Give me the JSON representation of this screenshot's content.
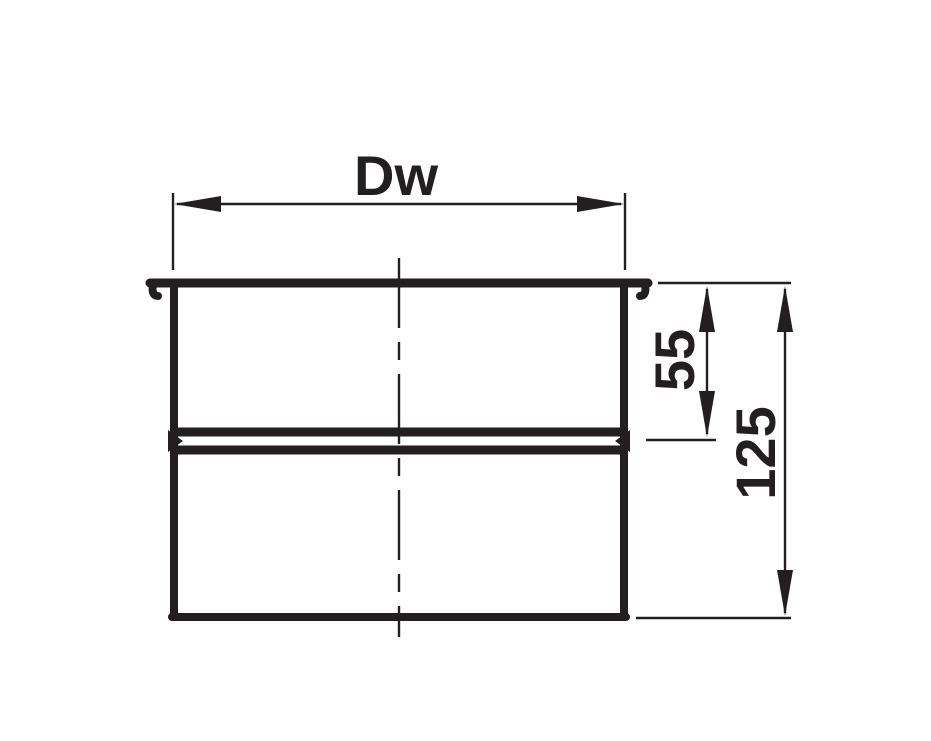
{
  "drawing": {
    "type": "technical-dimension-drawing",
    "background_color": "#ffffff",
    "line_color": "#231f20",
    "labels": {
      "inner_diameter": "Dw",
      "upper_section_height": "55",
      "total_height": "125"
    }
  }
}
